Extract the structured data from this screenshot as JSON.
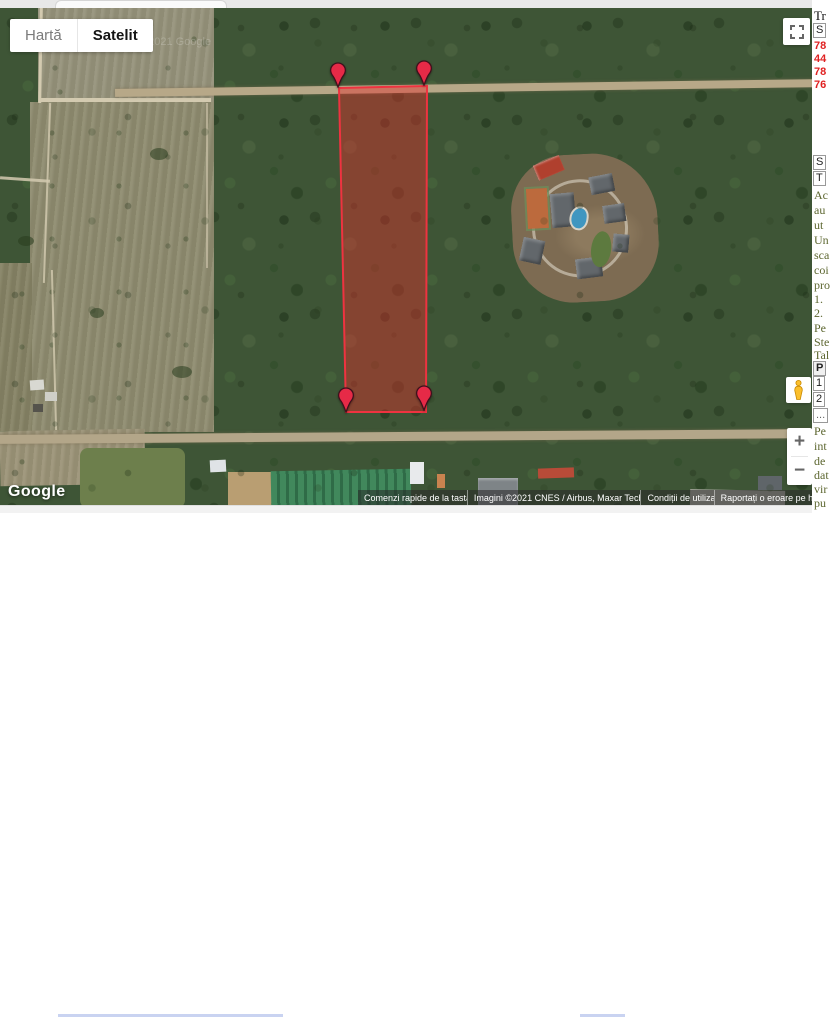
{
  "map_widget": {
    "type_control": {
      "map_label": "Hartă",
      "satellite_label": "Satelit",
      "selected": "Satelit"
    },
    "zoom_in_label": "+",
    "zoom_out_label": "−",
    "logo": "Google",
    "imagery_watermark": "©2021 Google",
    "attribution_items": [
      "Comenzi rapide de la tastatură",
      "Imagini ©2021 CNES / Airbus, Maxar Technologies",
      "Condiții de utilizare",
      "Raportați o eroare pe hartă"
    ],
    "overlay": {
      "polygon_fill": "rgba(232,46,44,0.42)",
      "polygon_stroke": "#ee3340",
      "marker_color": "#e62a47",
      "marker_count": 4
    }
  },
  "side_panel": {
    "title_fragment": "Tr",
    "table1_header": "S",
    "table1_values": [
      "78",
      "44",
      "78",
      "76"
    ],
    "section2_headers": [
      "S",
      "T"
    ],
    "text_fragments": [
      "Ac",
      "au",
      "ut",
      "Un",
      "sca",
      "coi",
      "pro",
      "1.",
      "2.",
      "Pe",
      "Ste",
      "Tal"
    ],
    "table2_header": "P",
    "table2_rows": [
      "1",
      "2",
      "..."
    ],
    "bottom_fragments": [
      "Pe",
      "int",
      "de",
      "dat",
      "vir",
      "pu"
    ]
  }
}
